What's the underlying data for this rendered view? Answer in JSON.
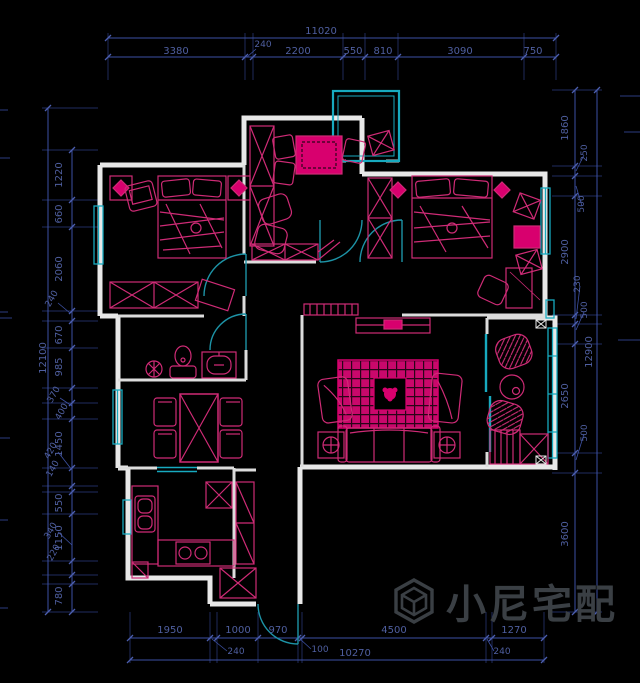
{
  "watermark": {
    "brand": "小尼宅配",
    "logo": "cube-hexagon-logo"
  },
  "colors": {
    "background": "#000000",
    "walls": "#e8e8e8",
    "furniture_line": "#cf2b76",
    "furniture_fill": "#d8006e",
    "windows": "#17aabf",
    "doors": "#1d93a6",
    "dimensions": "#4f5fa0",
    "watermark": "#3a3f44"
  },
  "dims": {
    "top": {
      "overall": "11020",
      "segments": [
        "3380",
        "240",
        "2200",
        "550",
        "810",
        "3090",
        "750"
      ]
    },
    "left": {
      "overall": "12100",
      "segments": [
        "1220",
        "660",
        "2060",
        "240",
        "670",
        "985",
        "370",
        "400",
        "1450",
        "420",
        "140",
        "550",
        "1150",
        "340",
        "220",
        "780"
      ]
    },
    "right": {
      "overall": "12900",
      "segments": [
        "1860",
        "250",
        "500",
        "2900",
        "230",
        "500",
        "2650",
        "500",
        "3600"
      ]
    },
    "bottom": {
      "overall": "10270",
      "segments": [
        "1950",
        "1000",
        "970",
        "4500",
        "1270"
      ],
      "offsets": [
        "240",
        "100",
        "240"
      ]
    }
  }
}
